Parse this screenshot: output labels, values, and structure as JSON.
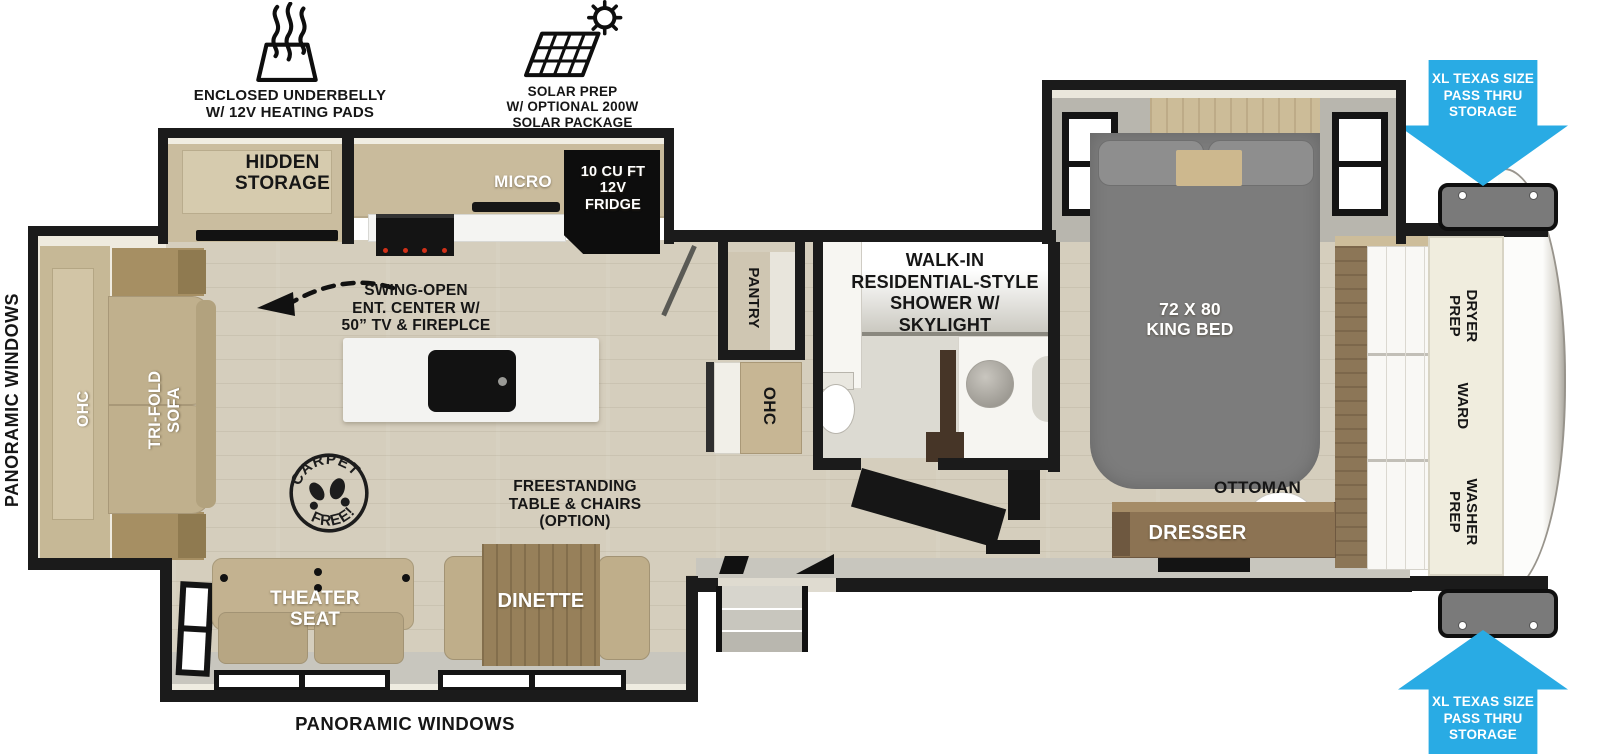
{
  "exterior": {
    "underbelly_label": [
      "ENCLOSED UNDERBELLY",
      "W/ 12V HEATING PADS"
    ],
    "solar_label": [
      "SOLAR PREP",
      "W/ OPTIONAL 200W",
      "SOLAR PACKAGE"
    ],
    "passthru_top": [
      "XL TEXAS SIZE",
      "PASS THRU",
      "STORAGE"
    ],
    "passthru_bottom": [
      "XL TEXAS SIZE",
      "PASS THRU",
      "STORAGE"
    ],
    "panoramic_left": "PANORAMIC WINDOWS",
    "panoramic_bottom": "PANORAMIC WINDOWS"
  },
  "kitchen": {
    "hidden_storage": [
      "HIDDEN",
      "STORAGE"
    ],
    "micro": "MICRO",
    "fridge": [
      "10 CU FT",
      "12V",
      "FRIDGE"
    ],
    "ent_center": [
      "SWING-OPEN",
      "ENT. CENTER W/",
      "50” TV & FIREPLCE"
    ],
    "pantry": "PANTRY",
    "ohc": "OHC"
  },
  "living": {
    "sofa_ohc": "OHC",
    "tri_fold_sofa": [
      "TRI-FOLD",
      "SOFA"
    ],
    "carpet_stamp": [
      "CARPET",
      "FREE!"
    ],
    "freestanding": [
      "FREESTANDING",
      "TABLE & CHAIRS",
      "(OPTION)"
    ],
    "theater_seat": [
      "THEATER",
      "SEAT"
    ],
    "dinette": "DINETTE"
  },
  "bathroom": {
    "shower": [
      "WALK-IN",
      "RESIDENTIAL-STYLE",
      "SHOWER W/",
      "SKYLIGHT"
    ]
  },
  "bedroom": {
    "king_bed": [
      "72 X 80",
      "KING BED"
    ],
    "ottoman": "OTTOMAN",
    "dresser": "DRESSER"
  },
  "front_closet": {
    "dryer": [
      "DRYER",
      "PREP"
    ],
    "ward": "WARD",
    "washer": [
      "WASHER",
      "PREP"
    ]
  },
  "colors": {
    "arrow_blue": "#29abe4",
    "wall_black": "#1b1b1b",
    "floor_wood": "#d5cebd",
    "furniture_tan": "#c3b290",
    "cabinet_wood": "#8c7353",
    "bed_gray": "#7c7c7c",
    "slide_lining_gray": "#c8c6be"
  }
}
